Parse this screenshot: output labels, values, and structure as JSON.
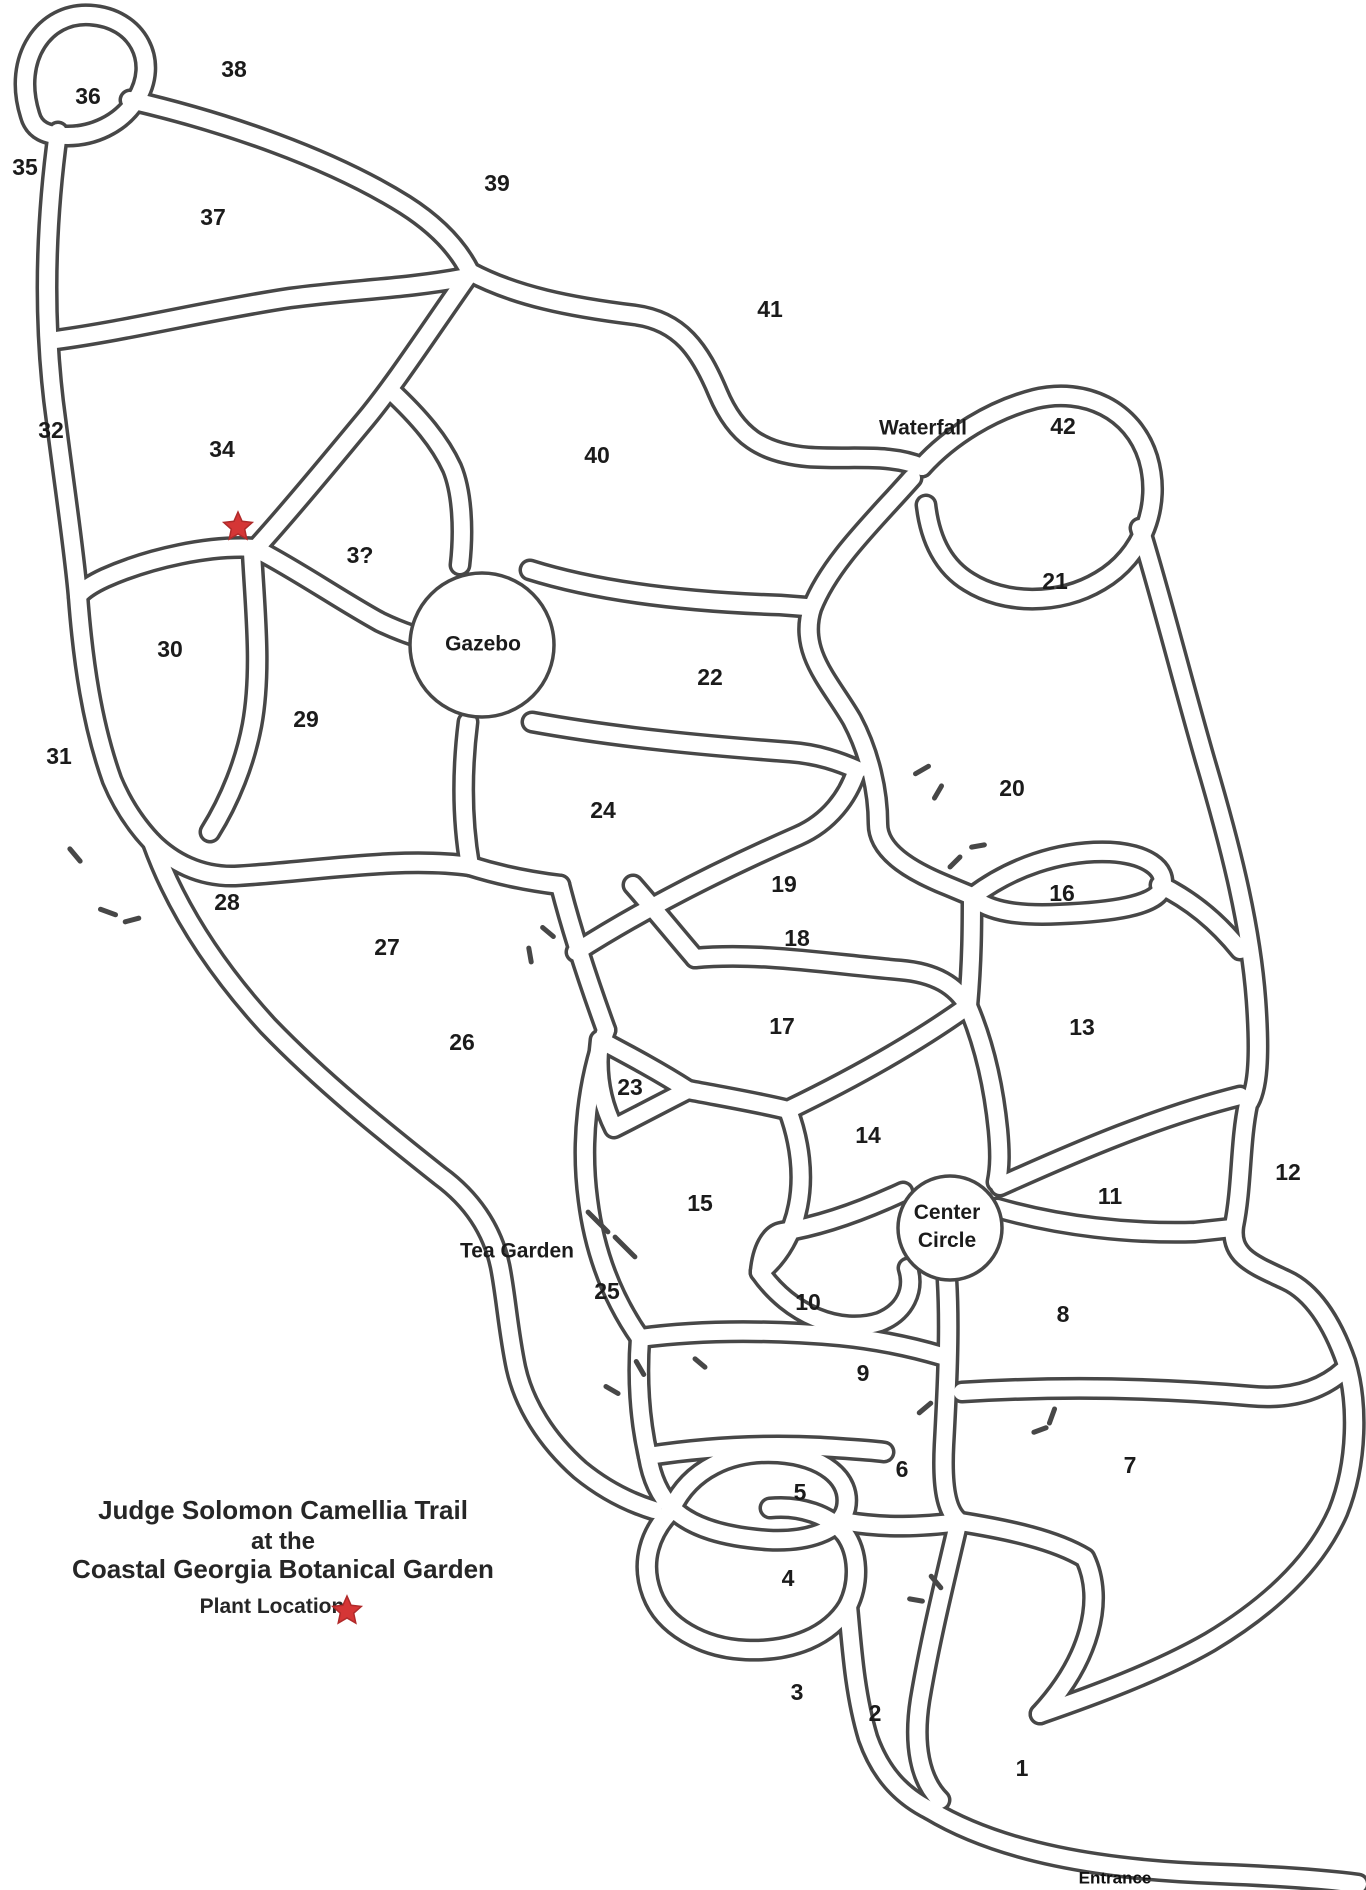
{
  "map_title": {
    "lines": [
      "Judge Solomon Camellia Trail",
      "at the",
      "Coastal Georgia Botanical Garden"
    ]
  },
  "legend": {
    "label": "Plant Location",
    "symbol": "red-star"
  },
  "colors": {
    "ink": "#474747",
    "label": "#1b1b1b",
    "star_red": "#d53636",
    "background": "#ffffff"
  },
  "map": {
    "bed_numbers": [
      {
        "text": "1",
        "x": 1022,
        "y": 1768
      },
      {
        "text": "2",
        "x": 875,
        "y": 1713
      },
      {
        "text": "3",
        "x": 797,
        "y": 1692
      },
      {
        "text": "4",
        "x": 788,
        "y": 1578
      },
      {
        "text": "5",
        "x": 800,
        "y": 1492
      },
      {
        "text": "6",
        "x": 902,
        "y": 1469
      },
      {
        "text": "7",
        "x": 1130,
        "y": 1465
      },
      {
        "text": "8",
        "x": 1063,
        "y": 1314
      },
      {
        "text": "9",
        "x": 863,
        "y": 1373
      },
      {
        "text": "10",
        "x": 808,
        "y": 1302
      },
      {
        "text": "11",
        "x": 1110,
        "y": 1196
      },
      {
        "text": "12",
        "x": 1288,
        "y": 1172
      },
      {
        "text": "13",
        "x": 1082,
        "y": 1027
      },
      {
        "text": "14",
        "x": 868,
        "y": 1135
      },
      {
        "text": "15",
        "x": 700,
        "y": 1203
      },
      {
        "text": "16",
        "x": 1062,
        "y": 893
      },
      {
        "text": "17",
        "x": 782,
        "y": 1026
      },
      {
        "text": "18",
        "x": 797,
        "y": 938
      },
      {
        "text": "19",
        "x": 784,
        "y": 884
      },
      {
        "text": "20",
        "x": 1012,
        "y": 788
      },
      {
        "text": "21",
        "x": 1055,
        "y": 581
      },
      {
        "text": "22",
        "x": 710,
        "y": 677
      },
      {
        "text": "23",
        "x": 630,
        "y": 1087
      },
      {
        "text": "24",
        "x": 603,
        "y": 810
      },
      {
        "text": "25",
        "x": 607,
        "y": 1291
      },
      {
        "text": "26",
        "x": 462,
        "y": 1042
      },
      {
        "text": "27",
        "x": 387,
        "y": 947
      },
      {
        "text": "28",
        "x": 227,
        "y": 902
      },
      {
        "text": "29",
        "x": 306,
        "y": 719
      },
      {
        "text": "30",
        "x": 170,
        "y": 649
      },
      {
        "text": "31",
        "x": 59,
        "y": 756
      },
      {
        "text": "32",
        "x": 51,
        "y": 430
      },
      {
        "text": "3?",
        "x": 360,
        "y": 555
      },
      {
        "text": "34",
        "x": 222,
        "y": 449
      },
      {
        "text": "35",
        "x": 25,
        "y": 167
      },
      {
        "text": "36",
        "x": 88,
        "y": 96
      },
      {
        "text": "37",
        "x": 213,
        "y": 217
      },
      {
        "text": "38",
        "x": 234,
        "y": 69
      },
      {
        "text": "39",
        "x": 497,
        "y": 183
      },
      {
        "text": "40",
        "x": 597,
        "y": 455
      },
      {
        "text": "41",
        "x": 770,
        "y": 309
      },
      {
        "text": "42",
        "x": 1063,
        "y": 426
      }
    ],
    "named_labels": [
      {
        "id": "gazebo",
        "text": "Gazebo",
        "x": 483,
        "y": 644
      },
      {
        "id": "waterfall",
        "text": "Waterfall",
        "x": 923,
        "y": 428
      },
      {
        "id": "tea-garden",
        "text": "Tea Garden",
        "x": 517,
        "y": 1251
      },
      {
        "id": "center-circle",
        "text": "Center Circle",
        "lines": [
          "Center",
          "Circle"
        ],
        "x": 947,
        "y": 1212,
        "line_height": 28
      },
      {
        "id": "entrance",
        "text": "Entrance",
        "x": 1115,
        "y": 1878
      }
    ],
    "plant_location_star": {
      "x": 238,
      "y": 527
    }
  }
}
